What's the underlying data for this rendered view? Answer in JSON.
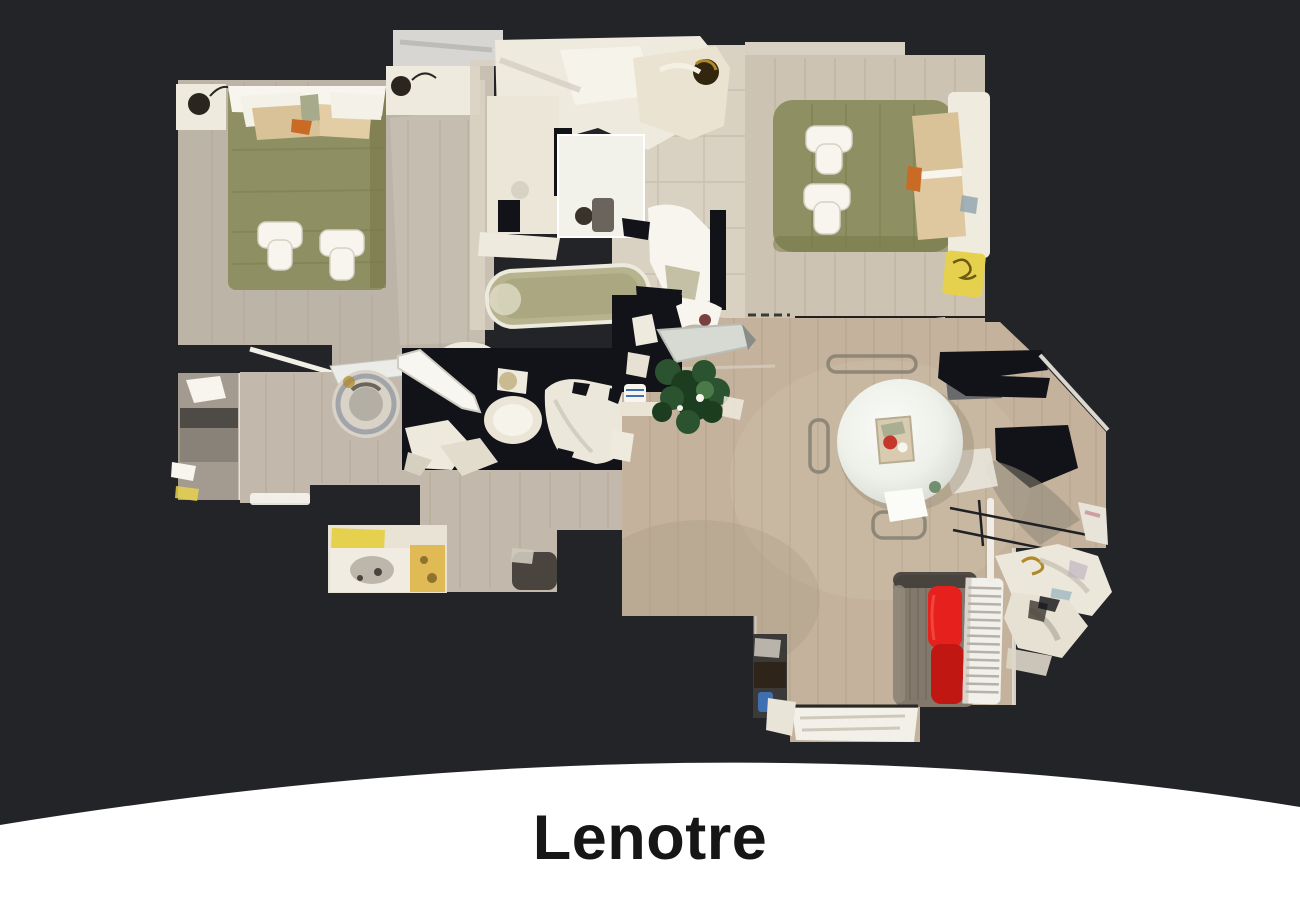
{
  "page": {
    "width_px": 1300,
    "height_px": 900
  },
  "footer": {
    "title": "Lenotre"
  },
  "floorplan": {
    "type": "3d-dollhouse-top-down-apartment-scan",
    "rooms": [
      {
        "name": "bedroom-left",
        "furniture": [
          "double-bed-olive-duvet",
          "white-and-tan-pillows",
          "two-folded-white-towels",
          "nightstand-with-black-lamp-left",
          "nightstand-with-black-lamp-right",
          "wall-shelf"
        ]
      },
      {
        "name": "bathroom-top",
        "furniture": [
          "bathtub",
          "vanity-mirror",
          "washbasin",
          "tiled-floor"
        ]
      },
      {
        "name": "bedroom-right",
        "furniture": [
          "double-bed-olive-duvet",
          "tan-pillows",
          "two-folded-white-towels",
          "yellow-bath-towel",
          "corner-wardrobe",
          "bedside-lamp"
        ]
      },
      {
        "name": "hallway",
        "furniture": [
          "open-white-doors",
          "door-threshold",
          "washing-machine"
        ]
      },
      {
        "name": "office-nook",
        "furniture": [
          "dark-desk",
          "white-papers",
          "yellow-towels"
        ]
      },
      {
        "name": "shower-room",
        "furniture": [
          "toilet",
          "shower-door",
          "white-fixtures"
        ]
      },
      {
        "name": "small-bathroom",
        "furniture": [
          "washbasin-counter",
          "yellow-towels",
          "yellow-bath-mat",
          "dark-stool"
        ]
      },
      {
        "name": "living-dining-room",
        "furniture": [
          "round-white-dining-table",
          "dining-chairs",
          "potted-plant",
          "floor-lamp",
          "gray-sofa-with-red-cushions",
          "white-radiator",
          "white-armchairs",
          "clothes-drying-rack",
          "dark-tv-stand",
          "window-sill"
        ]
      }
    ]
  },
  "palette": {
    "bg": "#232428",
    "hole": "#121318",
    "footerBg": "#ffffff",
    "titleColor": "#161616",
    "floorA": "#bdb4a8",
    "floorB": "#cdc3b2",
    "floorC": "#c2b8ab",
    "floorD": "#c4b29c",
    "floorE": "#a39b90",
    "tile": "#d9d1c2",
    "white1": "#efeade",
    "white2": "#f7f5ee",
    "olive": "#8e8f62",
    "oliveDark": "#767748",
    "tan": "#d9c298",
    "orange": "#c96a25",
    "yellow": "#e6d14e",
    "red": "#e6201d",
    "redDark": "#c01713",
    "sofa": "#82796c",
    "sofaDark": "#413e38",
    "plant": "#2c5330",
    "plantDark": "#1d3d20",
    "table": "#eef0ea",
    "tableShade": "#d3d6cf",
    "metal": "#9aa0a6",
    "plank": "#a6957e",
    "shadow": "#8d8779",
    "blue": "#3f6fb0",
    "teal": "#9fb9c0",
    "gold": "#b08828",
    "desk": "#4e4a45"
  }
}
